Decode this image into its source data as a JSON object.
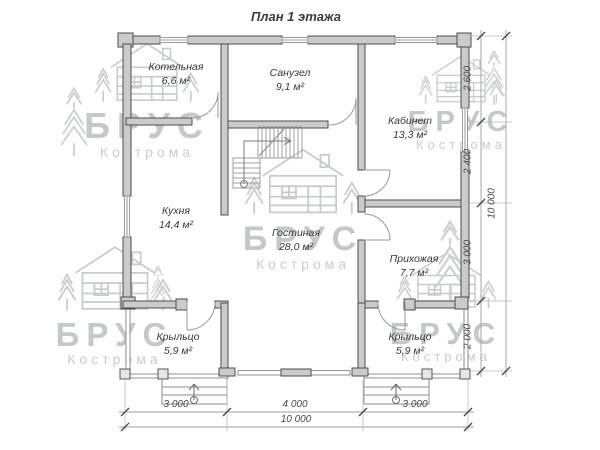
{
  "title": "План 1 этажа",
  "watermark": {
    "brand": "БРУС",
    "city": "Кострома"
  },
  "rooms": [
    {
      "id": "kotelnaya",
      "name": "Котельная",
      "area": "6,6 м²"
    },
    {
      "id": "sanuzel",
      "name": "Санузел",
      "area": "9,1 м²"
    },
    {
      "id": "kabinet",
      "name": "Кабинет",
      "area": "13,3 м²"
    },
    {
      "id": "kuhnya",
      "name": "Кухня",
      "area": "14,4 м²"
    },
    {
      "id": "gostinaya",
      "name": "Гостиная",
      "area": "28,0 м²"
    },
    {
      "id": "prihozhaya",
      "name": "Прихожая",
      "area": "7,7 м²"
    },
    {
      "id": "kryltso_left",
      "name": "Крыльцо",
      "area": "5,9 м²"
    },
    {
      "id": "kryltso_right",
      "name": "Крыльцо",
      "area": "5,9 м²"
    }
  ],
  "dimensions": {
    "right": [
      "2 600",
      "2 400",
      "3 000",
      "2 000"
    ],
    "right_total": "10 000",
    "bottom": [
      "3 000",
      "4 000",
      "3 000"
    ],
    "bottom_total": "10 000"
  },
  "colors": {
    "wall_fill": "#cbcbcb",
    "wall_stroke": "#4c4c4c",
    "thin_line": "#8f8f8f",
    "text": "#3a3a3a",
    "watermark": "#c3c8ca"
  }
}
